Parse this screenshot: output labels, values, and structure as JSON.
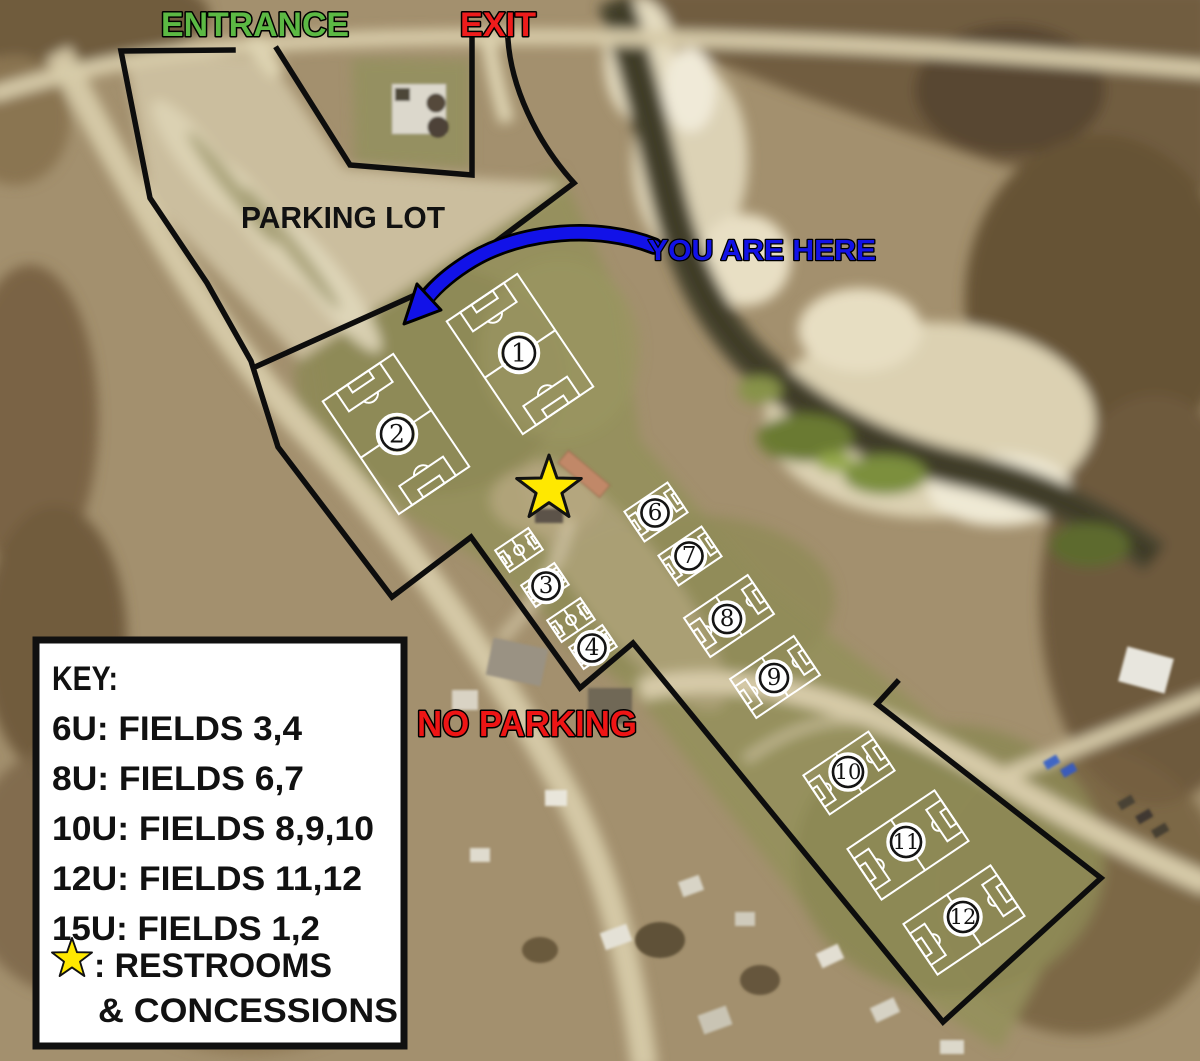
{
  "labels": {
    "entrance": "ENTRANCE",
    "exit": "EXIT",
    "parking_lot": "PARKING LOT",
    "you_are_here": "YOU ARE HERE",
    "no_parking": "NO PARKING"
  },
  "key": {
    "title": "KEY:",
    "lines": [
      "6U: FIELDS 3,4",
      "8U: FIELDS 6,7",
      "10U: FIELDS 8,9,10",
      "12U: FIELDS 11,12",
      "15U: FIELDS 1,2"
    ],
    "restrooms": ": RESTROOMS",
    "concessions": "& CONCESSIONS"
  },
  "fields": [
    {
      "number": "1"
    },
    {
      "number": "2"
    },
    {
      "number": "3"
    },
    {
      "number": "4"
    },
    {
      "number": "6"
    },
    {
      "number": "7"
    },
    {
      "number": "8"
    },
    {
      "number": "9"
    },
    {
      "number": "10"
    },
    {
      "number": "11"
    },
    {
      "number": "12"
    }
  ],
  "colors": {
    "entrance": "#5cb944",
    "exit": "#ee1c1c",
    "parking_lot": "#111111",
    "you_are_here": "#1212e8",
    "no_parking": "#ee1515",
    "star": "#ffe800",
    "boundary": "#0d0d0d",
    "field_lines": "#ffffff"
  }
}
